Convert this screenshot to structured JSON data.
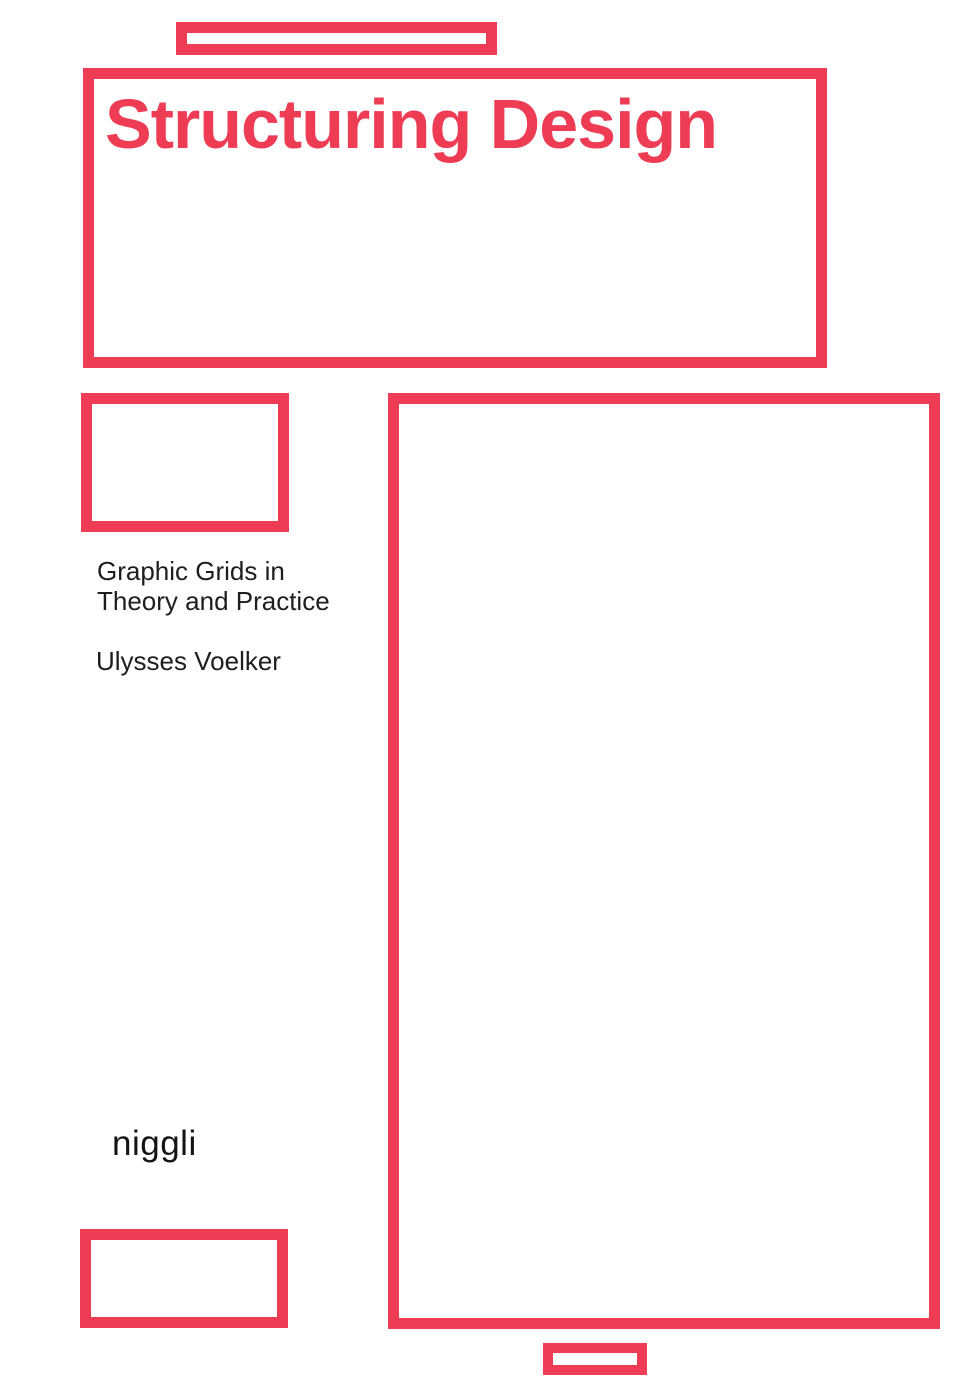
{
  "colors": {
    "accent": "#ee3c55",
    "text": "#1e1e20",
    "background": "#ffffff"
  },
  "cover": {
    "title": "Structuring Design",
    "subtitle_line1": "Graphic Grids in",
    "subtitle_line2": "Theory and Practice",
    "author": "Ulysses Voelker",
    "publisher": "niggli"
  }
}
